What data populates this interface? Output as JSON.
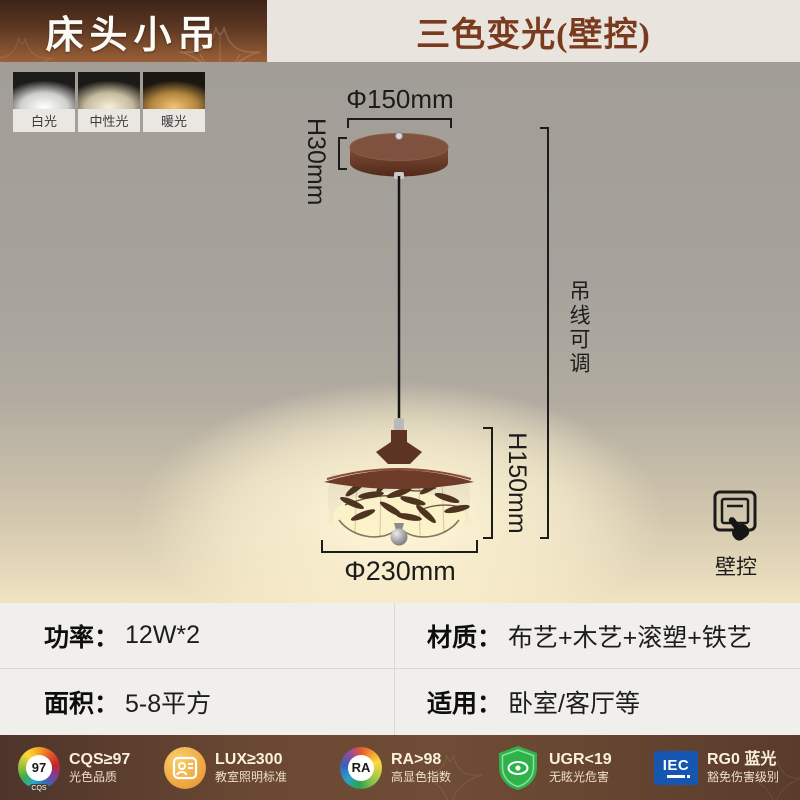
{
  "header": {
    "badge": "床头小吊",
    "title": "三色变光(壁控)"
  },
  "light_modes": [
    {
      "label": "白光",
      "glow": "#ffffff"
    },
    {
      "label": "中性光",
      "glow": "#f8efd8"
    },
    {
      "label": "暖光",
      "glow": "#f4c474"
    }
  ],
  "annotations": {
    "canopy_diameter": "Φ150mm",
    "canopy_height": "H30mm",
    "wire_adjust": "吊线可调",
    "shade_height": "H150mm",
    "shade_diameter": "Φ230mm",
    "wall_control": "壁控"
  },
  "specs": {
    "power": {
      "label": "功率：",
      "value": "12W*2"
    },
    "material": {
      "label": "材质：",
      "value": "布艺+木艺+滚塑+铁艺"
    },
    "area": {
      "label": "面积：",
      "value": "5-8平方"
    },
    "usage": {
      "label": "适用：",
      "value": "卧室/客厅等"
    }
  },
  "certifications": [
    {
      "icon": "cqs-starburst-icon",
      "center": "97",
      "sub": "CQS",
      "line1": "CQS≥97",
      "line2": "光色品质"
    },
    {
      "icon": "classroom-person-icon",
      "line1": "LUX≥300",
      "line2": "教室照明标准"
    },
    {
      "icon": "ra-color-wheel-icon",
      "center": "RA",
      "line1": "RA>98",
      "line2": "高显色指数"
    },
    {
      "icon": "ugr-shield-eye-icon",
      "line1": "UGR<19",
      "line2": "无眩光危害"
    },
    {
      "icon": "iec-logo-icon",
      "center": "IEC",
      "line1": "RG0 蓝光",
      "line2": "豁免伤害级别"
    }
  ],
  "colors": {
    "badge_gradient_top": "#3d2318",
    "badge_gradient_bottom": "#9a6038",
    "header_bg": "#e9e5de",
    "header_title_text": "#7a3a1e",
    "stage_gray": "#a5a19a",
    "warm_glow": "#fdf3d2",
    "wood_brown": "#6e3b2a",
    "shade_cream": "#f2e8c9",
    "table_bg": "#f1efec",
    "footer_brown": "#5e4030"
  }
}
